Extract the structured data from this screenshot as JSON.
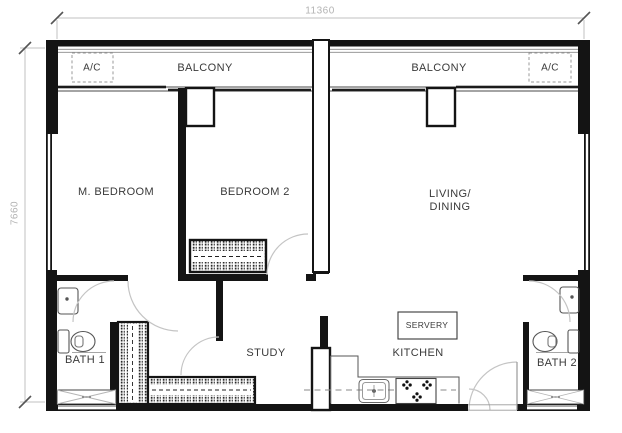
{
  "plan": {
    "dimensions": {
      "top": "11360",
      "left": "7660"
    },
    "rooms": {
      "balcony_left": "BALCONY",
      "balcony_right": "BALCONY",
      "ac_left": "A/C",
      "ac_right": "A/C",
      "m_bedroom": "M. BEDROOM",
      "bedroom2": "BEDROOM 2",
      "living_line1": "LIVING/",
      "living_line2": "DINING",
      "bath1": "BATH 1",
      "bath2": "BATH 2",
      "study": "STUDY",
      "kitchen": "KITCHEN",
      "servery": "SERVERY"
    },
    "colors": {
      "wall": "#141414",
      "thin_line": "#555555",
      "dimension": "#b3b3b3",
      "door_arc": "#c4c4c4",
      "text": "#3a3a3a",
      "background": "#ffffff"
    }
  }
}
